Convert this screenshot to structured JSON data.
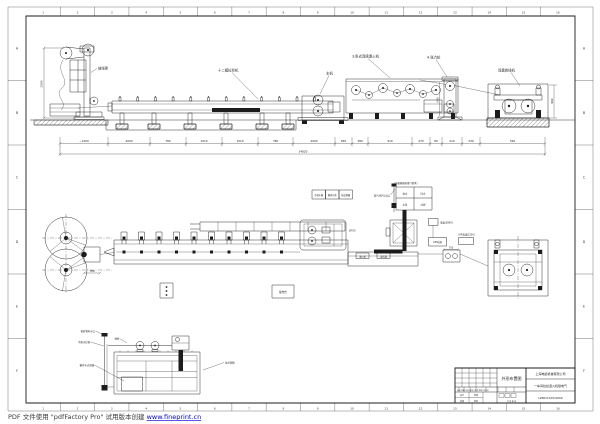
{
  "sheet": {
    "zone_columns": [
      "1",
      "2",
      "3",
      "4",
      "5",
      "6",
      "7",
      "8",
      "9",
      "10",
      "11",
      "12",
      "13",
      "14",
      "15",
      "16"
    ],
    "zone_rows": [
      "A",
      "B",
      "C",
      "D",
      "E",
      "F"
    ]
  },
  "elevation": {
    "labels": {
      "payoff": "放线架",
      "drawing_machine": "十二模拉丝机",
      "main_machine": "主机",
      "annealer": "3.卧式连续退火机",
      "tension": "4.张力轮",
      "takeup": "双盘收线机"
    },
    "dims": {
      "payoff_height": "2500",
      "chain": [
        "~1200",
        "2000",
        "780",
        "1510",
        "1510",
        "780",
        "2000",
        "650",
        "380",
        "910",
        "270",
        "80",
        "210",
        "230",
        "520"
      ],
      "overall": "34820",
      "takeup_height": "990",
      "accumulator_height": "1465"
    }
  },
  "plan": {
    "reel_dim": "780",
    "console": "操作台",
    "hull_note": "Ø700",
    "platform_tag1": "退火机",
    "platform_tag2": "变压器",
    "legend": [
      "冷却水箱",
      "循环水泵",
      "热交换器"
    ]
  },
  "schematic": {
    "caption": "(水箱规格按用户要求)",
    "cells": [
      "进水",
      "回水",
      "水泵",
      "过滤"
    ],
    "steam": "蒸汽(排气)出口",
    "power": "电源(380V)",
    "ups1": "UPS电源",
    "ups2": "UPS电源(220V)",
    "dim": "750"
  },
  "tank": {
    "fill_label": "接软管补水口",
    "level_label": "平衡水位管",
    "filter_label": "循环水过滤器",
    "screen_label": "滤网",
    "tank_label": "拉丝液箱"
  },
  "title_block": {
    "title": "外形布置图",
    "company": "上海电缆机械有限公司",
    "project": "一车间拉丝退火机组电气",
    "drawing_no": "LZ80-03/03-0000",
    "sign_row": "标记 处数 分区 更改文件号 签名 年月日",
    "design": "设计",
    "check": "校核",
    "review": "审核",
    "approve": "批准",
    "sheet_note": "共 张 第 张"
  },
  "watermark": {
    "prefix": "PDF 文件使用 \"pdfFactory Pro\" 试用版本创建 ",
    "link": "www.fineprint.cn"
  }
}
